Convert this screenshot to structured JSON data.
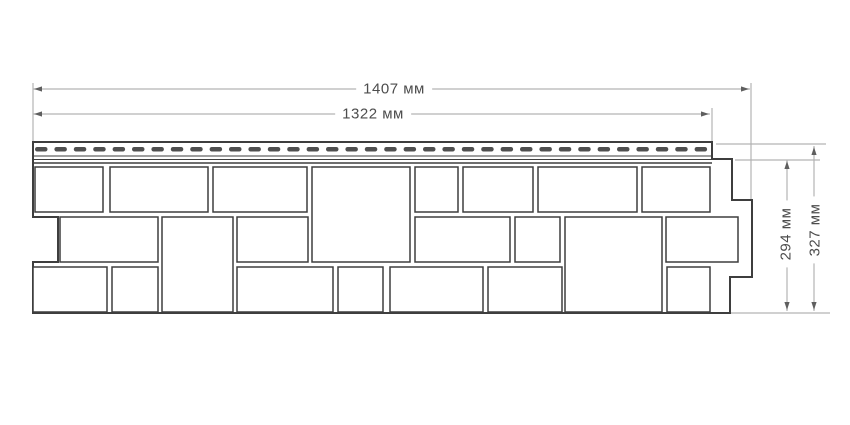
{
  "drawing_title": "facade-panel-technical-drawing",
  "dimensions": {
    "width_outer": "1407 мм",
    "width_inner": "1322 мм",
    "height_inner": "294 мм",
    "height_outer": "327 мм"
  },
  "colors": {
    "background": "#ffffff",
    "outline": "#3e3e3e",
    "block_fill": "#ffffff",
    "slot_fill": "#4f4f4f",
    "dim_line": "#b3b3b3",
    "arrow": "#5f5f5f",
    "text": "#4d4d4d"
  },
  "geometry": {
    "outline_path": "M 33,142 H 712 V 159 H 732 V 200 H 752 V 277 H 730 V 313 H 33 V 262 H 58 V 217 H 33 Z",
    "strip": {
      "x0": 33,
      "x1": 712,
      "line_ys": [
        156,
        159.5,
        163
      ],
      "dash": {
        "y": 147,
        "h": 4.5,
        "x_start": 35,
        "x_end": 708,
        "pitch": 19.4,
        "w": 12.5,
        "rx": 2.2
      }
    },
    "blocks": [
      [
        35,
        167,
        68,
        45
      ],
      [
        110,
        167,
        98,
        45
      ],
      [
        213,
        167,
        94,
        45
      ],
      [
        312,
        167,
        98,
        95
      ],
      [
        415,
        167,
        43,
        45
      ],
      [
        463,
        167,
        70,
        45
      ],
      [
        538,
        167,
        99,
        45
      ],
      [
        642,
        167,
        68,
        45
      ],
      [
        60,
        217,
        98,
        45
      ],
      [
        162,
        217,
        71,
        95
      ],
      [
        237,
        217,
        71,
        45
      ],
      [
        415,
        217,
        95,
        45
      ],
      [
        515,
        217,
        45,
        45
      ],
      [
        565,
        217,
        97,
        95
      ],
      [
        666,
        217,
        72,
        45
      ],
      [
        33,
        267,
        74,
        45
      ],
      [
        112,
        267,
        46,
        45
      ],
      [
        237,
        267,
        96,
        45
      ],
      [
        338,
        267,
        45,
        45
      ],
      [
        390,
        267,
        93,
        45
      ],
      [
        488,
        267,
        74,
        45
      ],
      [
        667,
        267,
        43,
        45
      ]
    ],
    "dim_lines": [
      [
        33,
        89,
        750,
        89
      ],
      [
        33,
        114,
        710,
        114
      ],
      [
        787,
        160,
        787,
        311
      ],
      [
        814,
        146,
        814,
        311
      ]
    ],
    "ext_lines": [
      [
        33,
        83,
        33,
        141
      ],
      [
        751,
        83,
        751,
        199
      ],
      [
        712,
        108,
        712,
        141
      ],
      [
        735,
        160,
        820,
        160
      ],
      [
        716,
        144,
        826,
        144
      ],
      [
        730,
        313,
        830,
        313
      ]
    ],
    "arrows": [
      [
        34,
        89,
        "l"
      ],
      [
        749,
        89,
        "r"
      ],
      [
        34,
        114,
        "l"
      ],
      [
        709,
        114,
        "r"
      ],
      [
        787,
        161,
        "u"
      ],
      [
        787,
        310,
        "d"
      ],
      [
        814,
        147,
        "u"
      ],
      [
        814,
        310,
        "d"
      ]
    ]
  }
}
